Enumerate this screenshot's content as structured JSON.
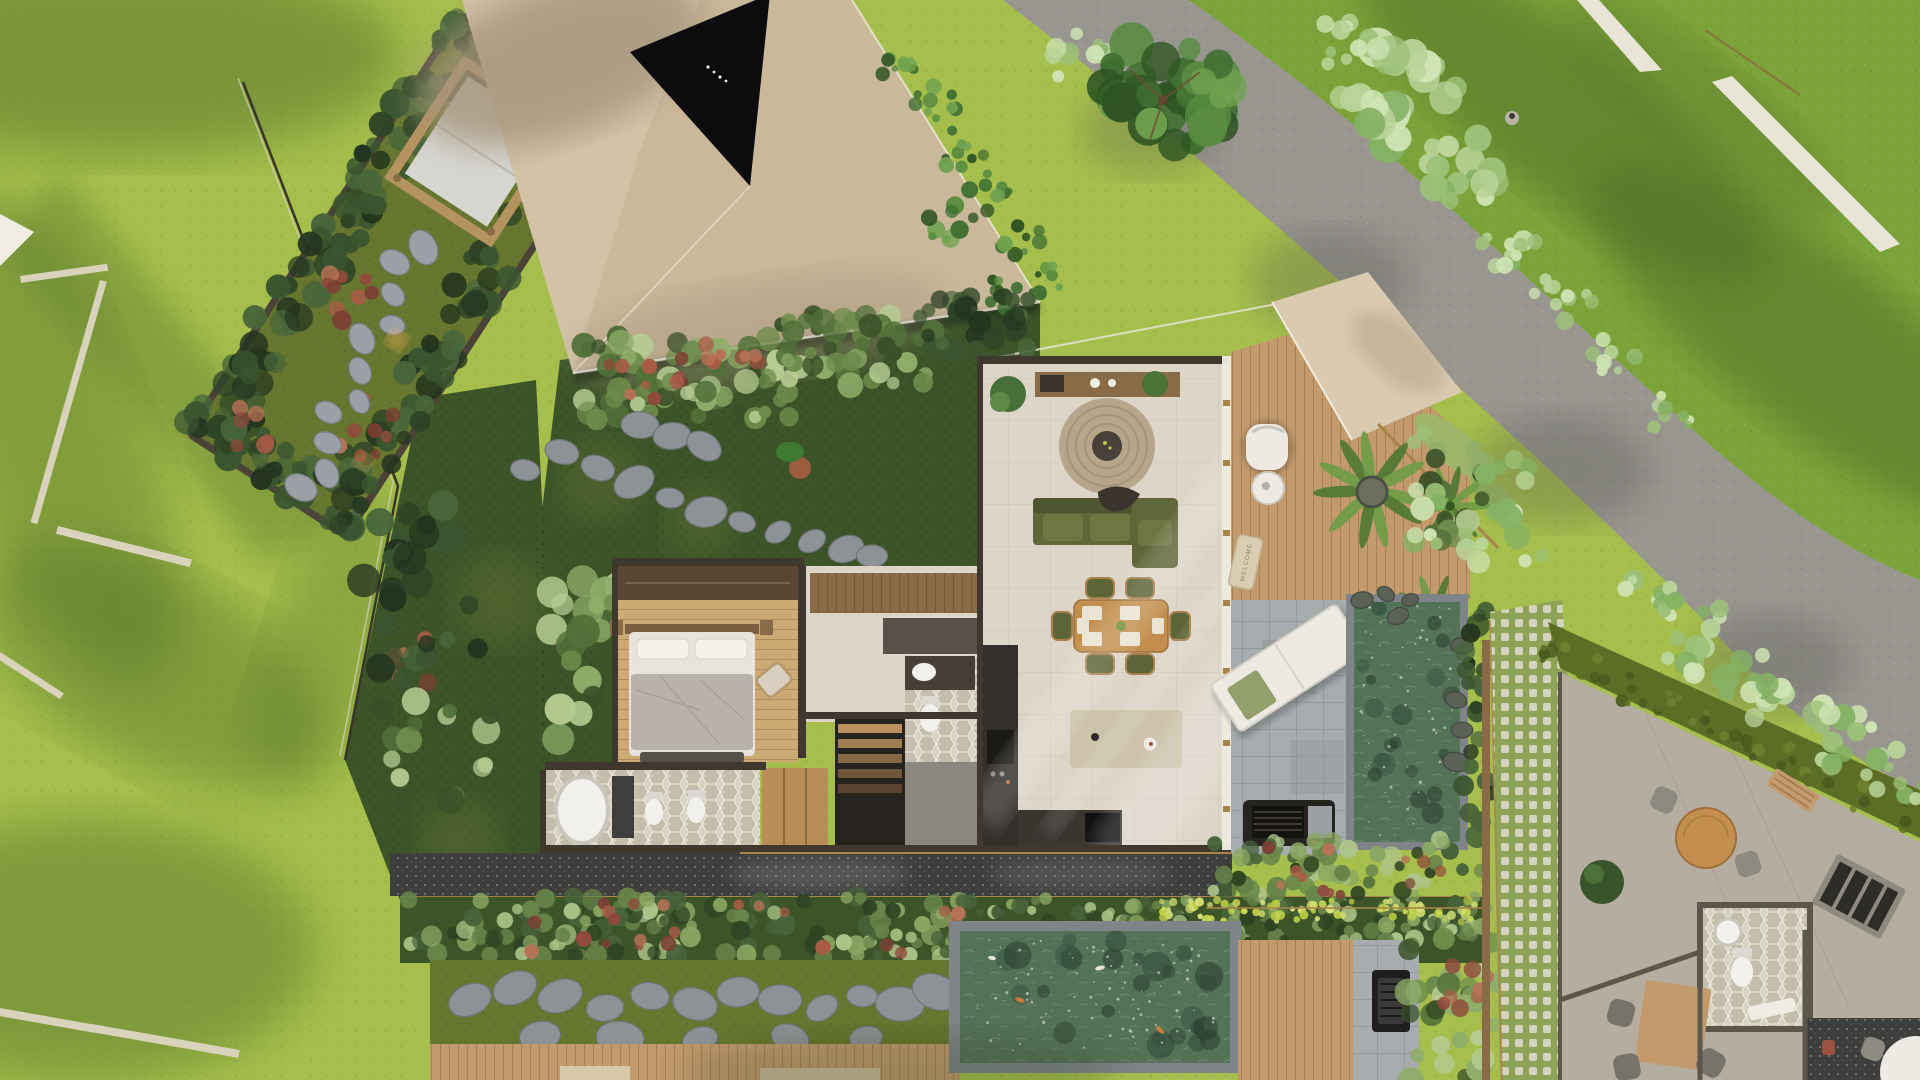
{
  "labels": {
    "welcome_mat": "WELCOME"
  },
  "colors": {
    "lawn_left": "#a6bf4c",
    "lawn_left_deep": "#8aa839",
    "lawn_shadow": "#4f6e28",
    "lawn_tr": "#7ca23a",
    "road": "#98968f",
    "road_shadow": "#55554e",
    "roof": "#c9b89a",
    "roof_light": "#d9cab0",
    "roof_shadow": "#a5947b",
    "skylight": "#0c0c0e",
    "court_grass": "#3d5429",
    "moss": "#68772f",
    "moss_light": "#84933c",
    "stone": "#8d9296",
    "stone_dark": "#6f7478",
    "wall": "#40372e",
    "wood_deck": "#c29a6c",
    "wood_dark": "#8a6b47",
    "bedroom_floor": "#cda974",
    "wardrobe": "#b98d58",
    "tile_floor": "#ddd5c8",
    "sofa": "#5f6639",
    "sofa_light": "#6f7644",
    "rug": "#b5a68c",
    "rug_center": "#474139",
    "table_wood": "#c28f4e",
    "chair_green": "#5c6537",
    "placemat": "#e9e3d3",
    "island": "#d6cdb6",
    "counter_dark": "#33302b",
    "pavers": "#a7acae",
    "pavers_line": "#84898c",
    "water": "#547257",
    "water_light": "#7d9a80",
    "pool_coping": "#7e8487",
    "terrazzo": "#3e3e3c",
    "bed_duvet": "#b8b2a8",
    "bed_sheet": "#e7e3da",
    "white_furniture": "#eceae3",
    "brass": "#a8834a",
    "hedge": "#5c6e26",
    "tree_light": "#a8c487",
    "tree_dark": "#417033",
    "lattice_bg": "#8fa356",
    "lattice_dot": "#ddd8c9",
    "terrace": "#b5ada0",
    "red_plant": "#9b5340",
    "glass": "#f0ede6",
    "welcome_mat": "#d9cdb4",
    "welcome_text": "#8a7f63",
    "fire": "#1f1e1c",
    "bbq": "#26241f",
    "hex_a": "#d8d2c2",
    "hex_b": "#c4bdab",
    "edging": "#d9d3bb"
  }
}
